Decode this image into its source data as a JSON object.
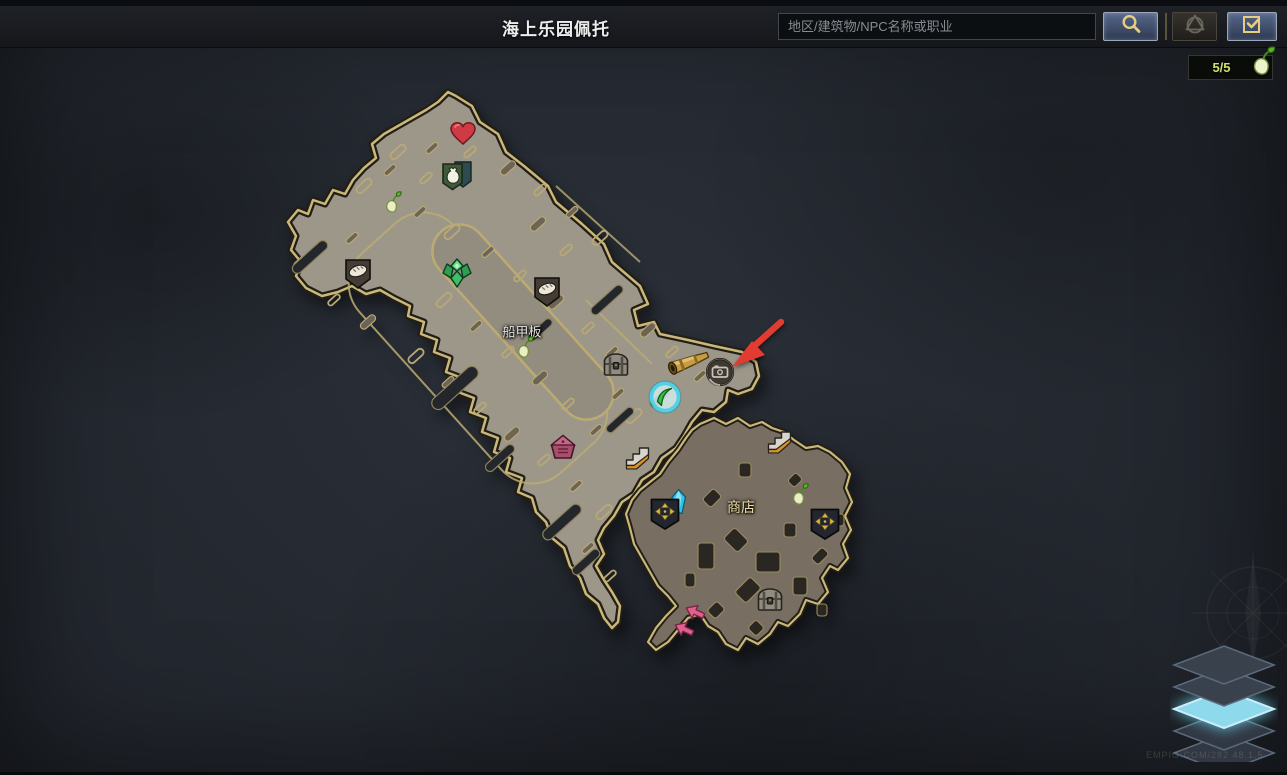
{
  "header": {
    "title": "海上乐园佩托",
    "search_placeholder": "地区/建筑物/NPC名称或职业"
  },
  "seed_counter": {
    "value": "5/5"
  },
  "map": {
    "labels": [
      {
        "text": "船甲板",
        "x": 522,
        "y": 331,
        "style": "area"
      },
      {
        "text": "商店",
        "x": 741,
        "y": 507,
        "style": "shop"
      }
    ],
    "markers": [
      {
        "type": "heart",
        "name": "favorite-heart-icon",
        "x": 463,
        "y": 134
      },
      {
        "type": "supply",
        "name": "supply-chest-icon",
        "x": 457,
        "y": 175
      },
      {
        "type": "sprout",
        "name": "mokoko-seed-icon",
        "x": 393,
        "y": 202
      },
      {
        "type": "bread",
        "name": "food-vendor-icon",
        "x": 358,
        "y": 274
      },
      {
        "type": "crystalGreen",
        "name": "green-crystal-icon",
        "x": 457,
        "y": 273
      },
      {
        "type": "bread",
        "name": "food-vendor-icon",
        "x": 547,
        "y": 292
      },
      {
        "type": "sprout",
        "name": "mokoko-seed-icon",
        "x": 525,
        "y": 347
      },
      {
        "type": "chest",
        "name": "chest-icon",
        "x": 616,
        "y": 365
      },
      {
        "type": "cannon",
        "name": "cannon-icon",
        "x": 689,
        "y": 362
      },
      {
        "type": "viewpoint",
        "name": "viewpoint-icon",
        "x": 720,
        "y": 373
      },
      {
        "type": "player",
        "name": "player-position-marker",
        "x": 665,
        "y": 397
      },
      {
        "type": "house",
        "name": "landmark-house-icon",
        "x": 563,
        "y": 447
      },
      {
        "type": "stairs",
        "name": "stairs-icon",
        "x": 638,
        "y": 457
      },
      {
        "type": "stairs",
        "name": "stairs-icon",
        "x": 780,
        "y": 441
      },
      {
        "type": "crystalCyan",
        "name": "cyan-crystal-icon",
        "x": 679,
        "y": 502
      },
      {
        "type": "crossBadge",
        "name": "general-merchant-icon",
        "x": 665,
        "y": 514
      },
      {
        "type": "sprout",
        "name": "mokoko-seed-icon",
        "x": 800,
        "y": 494
      },
      {
        "type": "crossBadge",
        "name": "general-merchant-icon",
        "x": 825,
        "y": 524
      },
      {
        "type": "chest",
        "name": "chest-icon",
        "x": 770,
        "y": 600
      },
      {
        "type": "arrowPink",
        "name": "exit-arrow-icon",
        "x": 695,
        "y": 612,
        "rot": 205
      },
      {
        "type": "arrowPink",
        "name": "exit-arrow-icon",
        "x": 684,
        "y": 629,
        "rot": 205
      },
      {
        "type": "redArrow",
        "name": "pointer-arrow-icon",
        "x": 721,
        "y": 318,
        "anchor": "tl"
      }
    ]
  },
  "layers_button": {
    "count": 5,
    "active_index": 2
  },
  "watermark": "EMPIG.COM/282 48.1.5",
  "colors": {
    "deck": "#9d978a",
    "shop": "#786e61",
    "gold_outline": "#c9b87b",
    "accent_cyan": "#7fd9ef",
    "seed_green": "#cfe06b",
    "pointer_red": "#e23b32"
  }
}
